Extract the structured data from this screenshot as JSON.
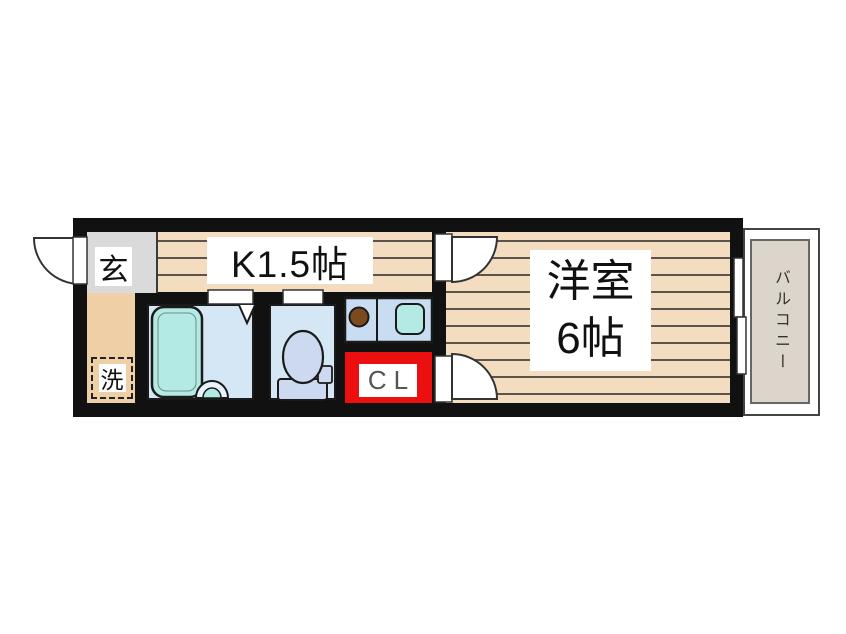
{
  "floorplan": {
    "rooms": {
      "entrance_label": "玄",
      "kitchen_label": "K1.5帖",
      "laundry_label": "洗",
      "closet_label": "CL",
      "main_room_name": "洋室",
      "main_room_size": "6帖",
      "balcony_label": "バルコニー"
    },
    "colors": {
      "wall": "#111111",
      "wood_floor": "#f4dcc0",
      "floor_stripe": "#5b544a",
      "earth_floor_tan": "#efcfa5",
      "entrance_gray": "#dadada",
      "wet_room_blue": "#d5e6f5",
      "counter_blue": "#c9ddf2",
      "fixture_teal": "#b4eae4",
      "toilet_fixture_blue": "#ccd9f0",
      "burner_brown": "#7b4a1e",
      "closet_red": "#ec0f0f",
      "balcony_gray": "#dcd5cb"
    }
  }
}
